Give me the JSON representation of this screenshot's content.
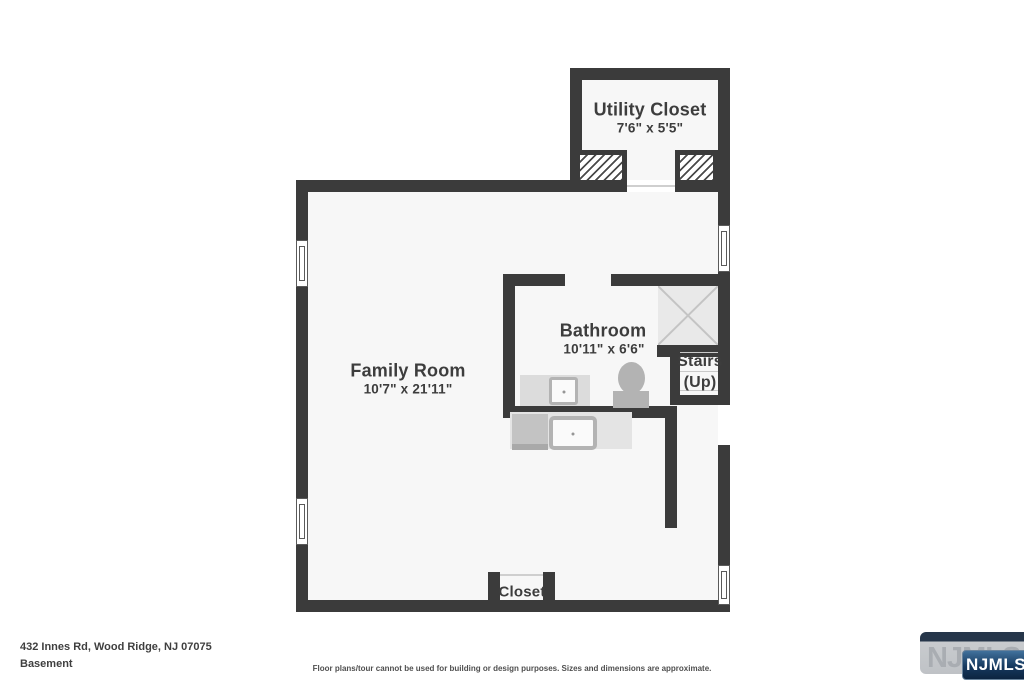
{
  "plan": {
    "rooms": {
      "utility_closet": {
        "name": "Utility Closet",
        "dims": "7'6\" x 5'5\""
      },
      "family_room": {
        "name": "Family Room",
        "dims": "10'7\" x 21'11\""
      },
      "bathroom": {
        "name": "Bathroom",
        "dims": "10'11\" x 6'6\""
      },
      "stairs": {
        "name": "Stairs",
        "direction": "(Up)"
      },
      "closet": {
        "name": "Closet"
      }
    }
  },
  "footer": {
    "address": "432 Innes Rd, Wood Ridge, NJ 07075",
    "level": "Basement",
    "disclaimer": "Floor plans/tour cannot be used for building or design purposes. Sizes and dimensions are approximate."
  },
  "logo": {
    "watermark_text": "NJMLS",
    "badge_text": "NJMLS"
  },
  "colors": {
    "wall": "#3b3b3b",
    "room_fill": "#f7f7f7",
    "fixture_gray": "#b3b3b3",
    "label_text": "#3d3d3d",
    "logo_blue": "#16395f"
  }
}
